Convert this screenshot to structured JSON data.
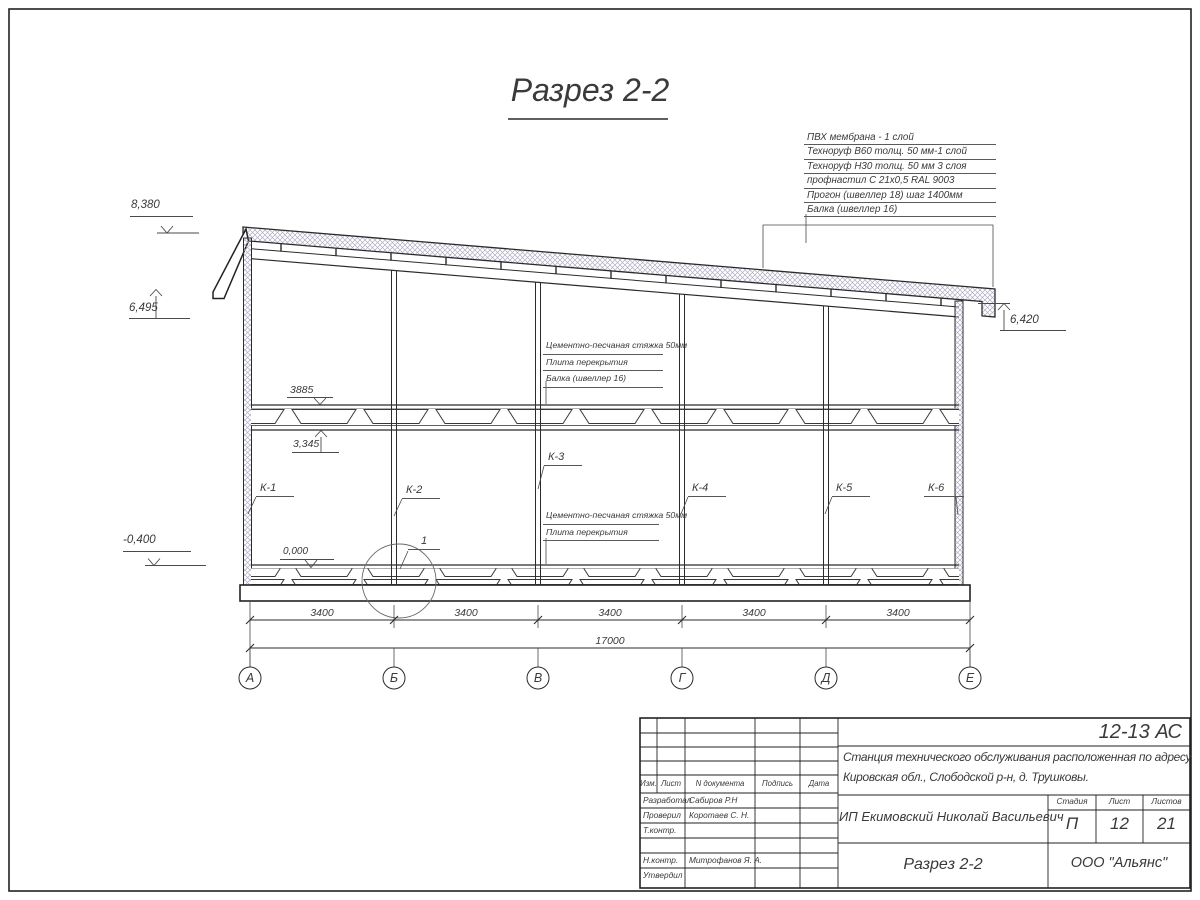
{
  "title": "Разрез 2-2",
  "roof_annotations": [
    "ПВХ мембрана - 1 слой",
    "Техноруф В60 толщ. 50 мм-1 слой",
    "Техноруф Н30 толщ. 50 мм 3 слоя",
    "профнастил С 21х0,5 RAL 9003",
    "Прогон (швеллер 18) шаг 1400мм",
    "Балка (швеллер 16)"
  ],
  "floor_annotations": [
    "Цементно-песчаная стяжка 50мм",
    "Плита перекрытия",
    "Балка (швеллер 16)"
  ],
  "ground_annotations": [
    "Цементно-песчаная стяжка 50мм",
    "Плита перекрытия"
  ],
  "elevations": {
    "roof_high": "8,380",
    "eave_left": "6,495",
    "eave_right": "6,420",
    "slab_top": "3885",
    "beam_bottom": "3,345",
    "floor_zero": "0,000",
    "ground": "-0,400"
  },
  "column_labels": [
    "К-1",
    "К-2",
    "К-3",
    "К-4",
    "К-5",
    "К-6"
  ],
  "detail_callout": "1",
  "dimensions": {
    "bays": [
      "3400",
      "3400",
      "3400",
      "3400",
      "3400"
    ],
    "total": "17000"
  },
  "grid_axes": [
    "А",
    "Б",
    "В",
    "Г",
    "Д",
    "Е"
  ],
  "title_block": {
    "code": "12-13 АС",
    "project_line1": "Станция технического обслуживания расположенная по адресу",
    "project_line2": "Кировская обл., Слободской р-н, д. Трушковы.",
    "client": "ИП Екимовский Николай Васильевич",
    "sheet_title": "Разрез 2-2",
    "organization": "ООО \"Альянс\"",
    "stage_label": "Стадия",
    "sheet_label": "Лист",
    "sheets_label": "Листов",
    "stage": "П",
    "sheet": "12",
    "sheets": "21",
    "col_izm": "Изм.",
    "col_list": "Лист",
    "col_ndoc": "N документа",
    "col_sign": "Подпись",
    "col_date": "Дата",
    "roles": [
      {
        "role": "Разработал",
        "name": "Сабиров Р.Н"
      },
      {
        "role": "Проверил",
        "name": "Коротаев С. Н."
      },
      {
        "role": "Т.контр.",
        "name": ""
      },
      {
        "role": "",
        "name": ""
      },
      {
        "role": "Н.контр.",
        "name": "Митрофанов Я. А."
      },
      {
        "role": "Утвердил",
        "name": ""
      }
    ]
  }
}
